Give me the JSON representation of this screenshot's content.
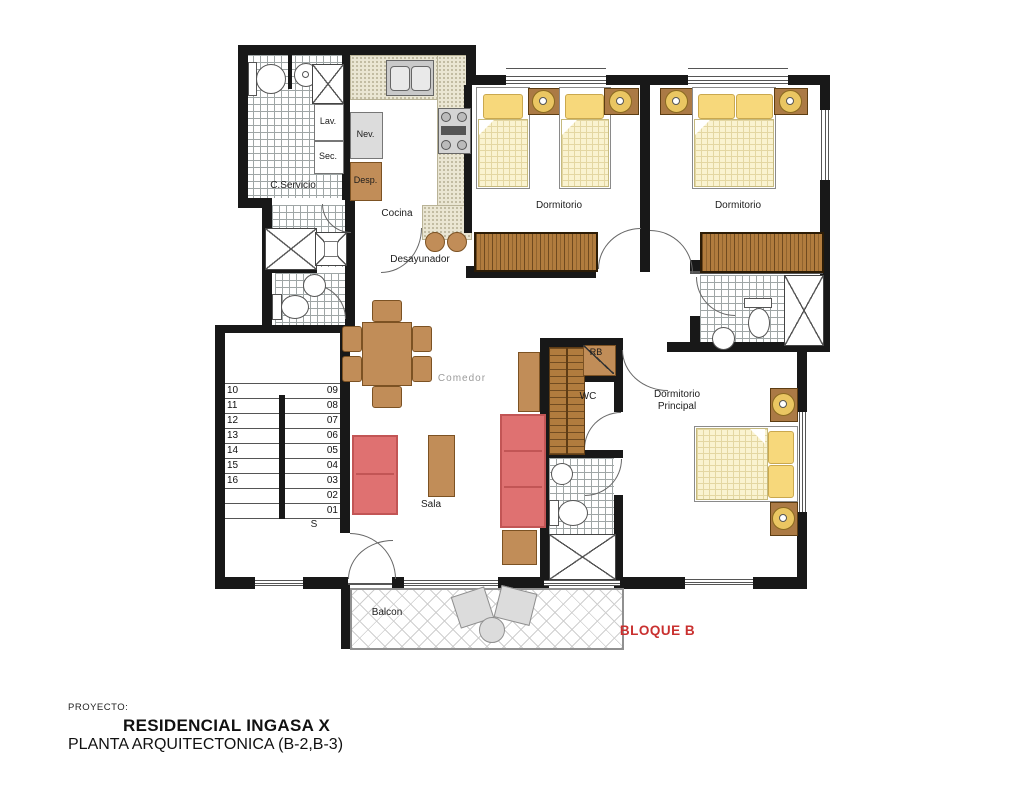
{
  "plan": {
    "block_label": "BLOQUE B",
    "rooms": {
      "c_servicio": "C.Servicio",
      "cocina": "Cocina",
      "desayunador": "Desayunador",
      "dormitorio_1": "Dormitorio",
      "dormitorio_2": "Dormitorio",
      "dormitorio_principal_l1": "Dormitorio",
      "dormitorio_principal_l2": "Principal",
      "comedor": "Comedor",
      "sala": "Sala",
      "balcon": "Balcon"
    },
    "fixtures": {
      "lav": "Lav.",
      "sec": "Sec.",
      "nev": "Nev.",
      "desp": "Desp.",
      "rb": "RB",
      "wc": "WC"
    },
    "stairs": {
      "direction_label": "S",
      "left_numbers": [
        "10",
        "11",
        "12",
        "13",
        "14",
        "15",
        "16"
      ],
      "right_numbers": [
        "09",
        "08",
        "07",
        "06",
        "05",
        "04",
        "03",
        "02",
        "01"
      ]
    }
  },
  "title_block": {
    "project_label": "PROYECTO:",
    "project_name": "RESIDENCIAL INGASA X",
    "plan_title": "PLANTA ARQUITECTONICA (B-2,B-3)"
  },
  "colors": {
    "wall": "#181818",
    "wood": "#c18d58",
    "closet": "#b17c3e",
    "sofa": "#df7171",
    "bed_quilt": "#faf3d0",
    "pillow": "#f7d87b",
    "counter": "#eae6d3",
    "balcony_furniture": "#dcdcdc",
    "block_label_red": "#c9302f"
  }
}
